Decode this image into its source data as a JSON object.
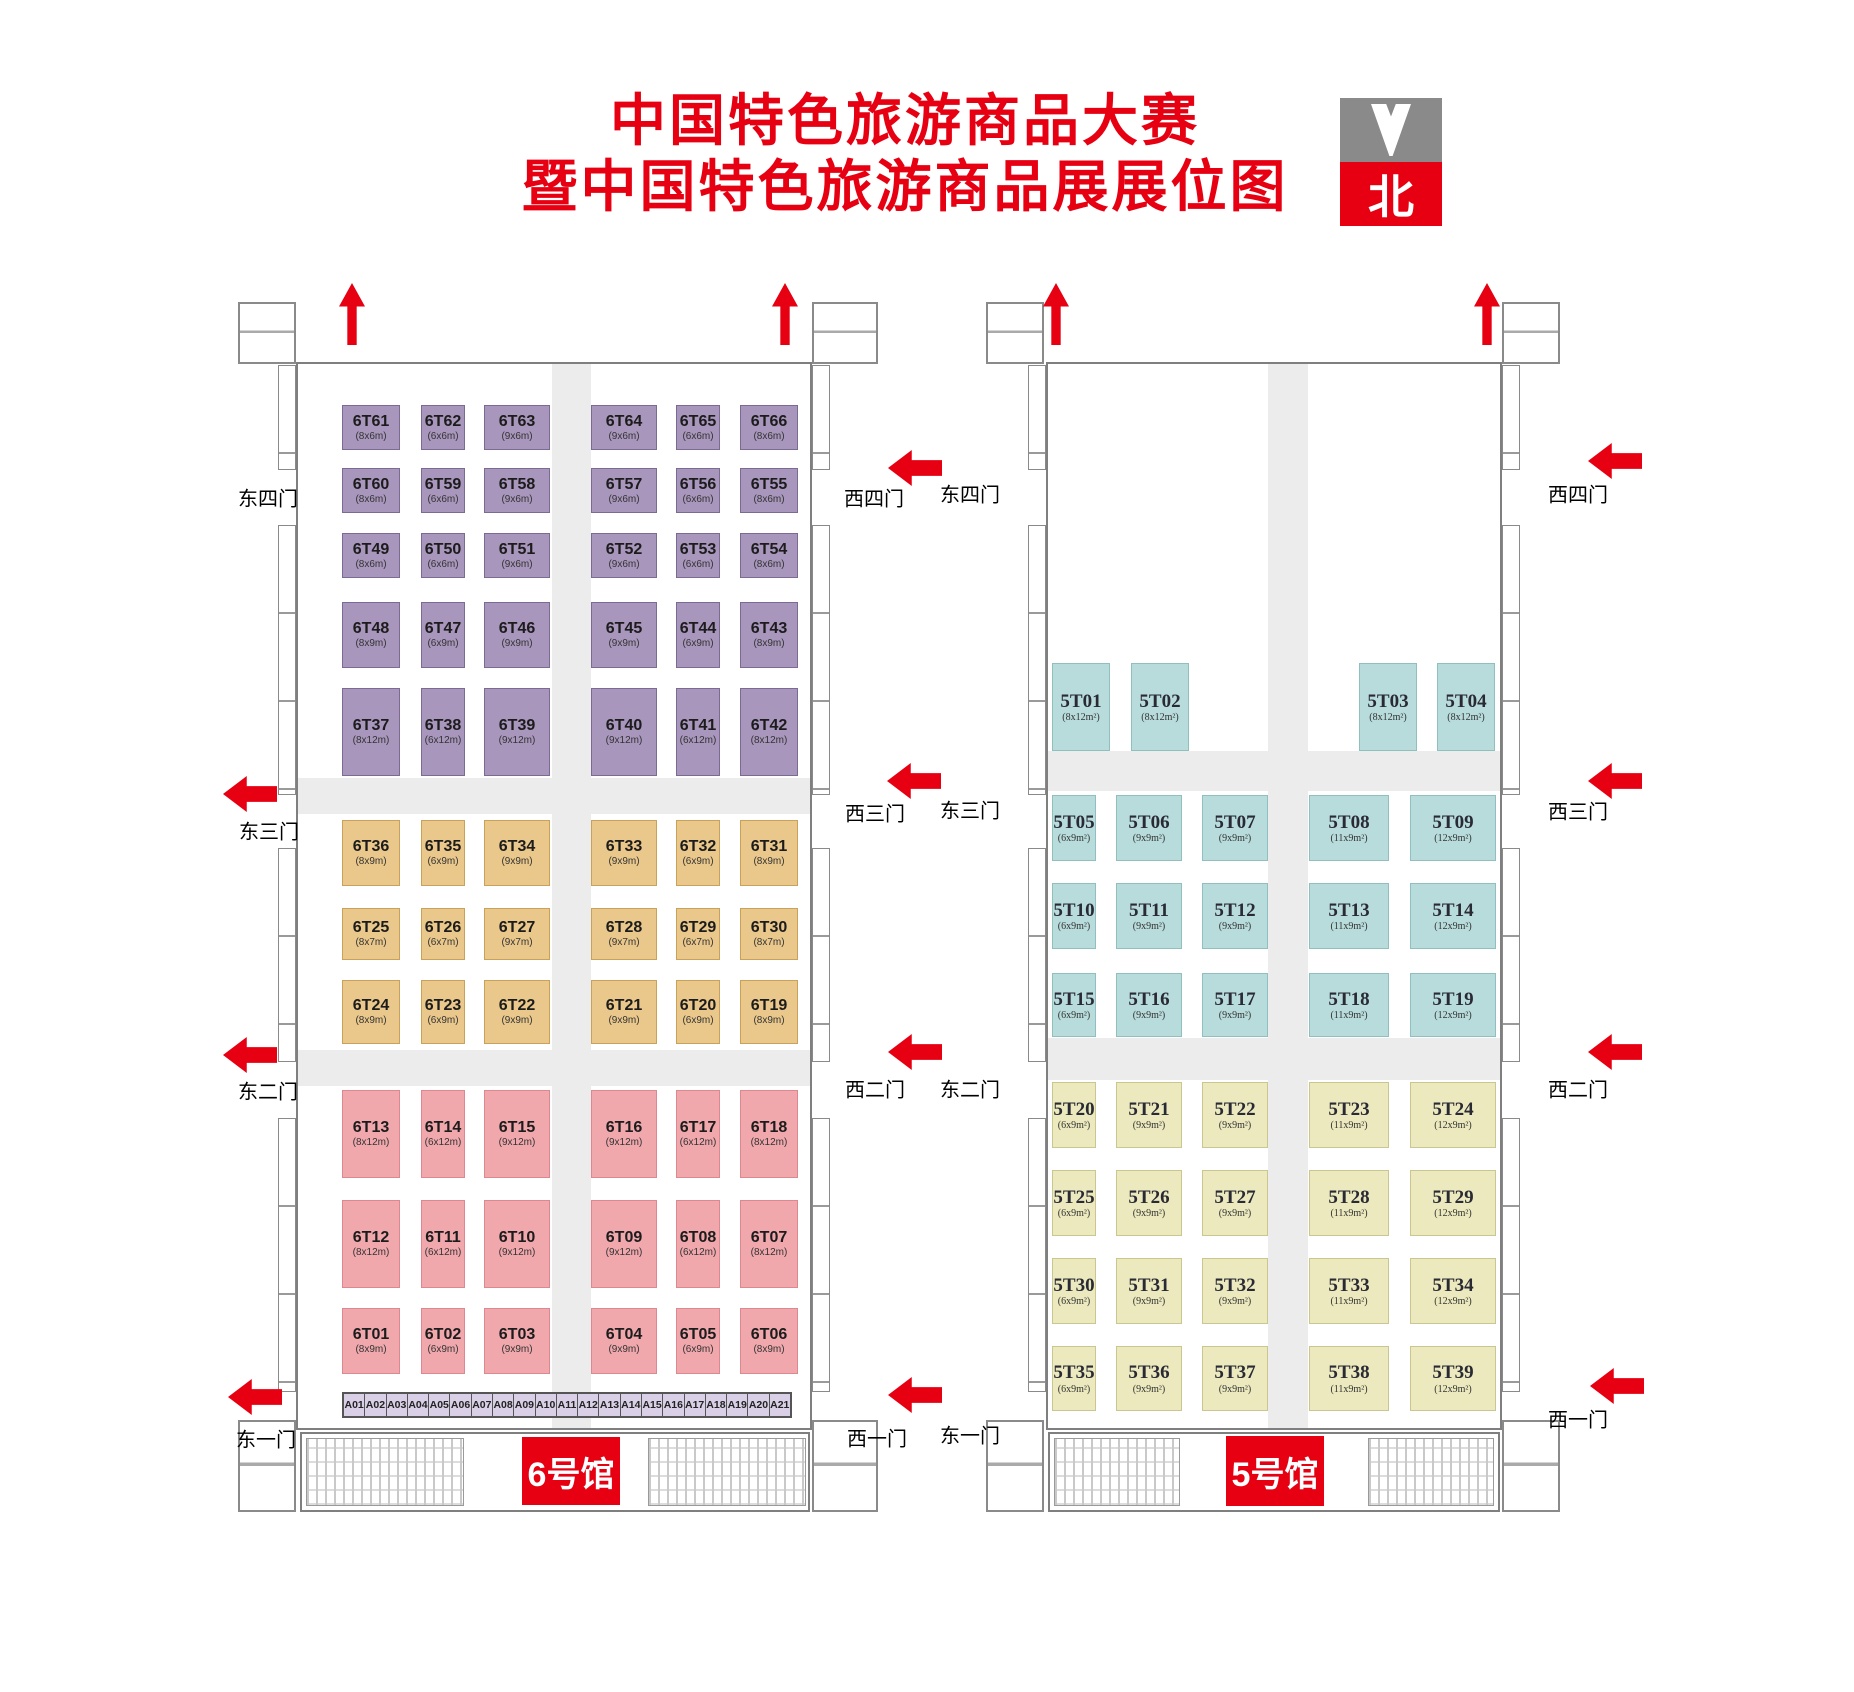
{
  "title": {
    "line1": "中国特色旅游商品大赛",
    "line2": "暨中国特色旅游商品展展位图"
  },
  "compass": {
    "label": "北"
  },
  "colors": {
    "red": "#e60012",
    "purple_booth": "#a896bc",
    "tan_booth": "#eac88b",
    "pink_booth": "#f1a8ad",
    "strip_booth": "#d9cfe6",
    "cyan_booth": "#b7dcdb",
    "yellow_booth": "#ebe9bd",
    "zone_pink": "#f7b3be",
    "aisle_gray": "#ececec",
    "aisle_text_orange": "#d9864f"
  },
  "hall6": {
    "badge": "6号馆",
    "main_aisle_label": "主通道",
    "gates_east": [
      "东四门",
      "东三门",
      "东二门",
      "东一门"
    ],
    "gates_west": [
      "西四门",
      "西三门",
      "西二门",
      "西一门"
    ],
    "booth_rows": [
      {
        "section": "purple",
        "booths": [
          [
            "6T61",
            "(8x6m)"
          ],
          [
            "6T62",
            "(6x6m)"
          ],
          [
            "6T63",
            "(9x6m)"
          ],
          [
            "6T64",
            "(9x6m)"
          ],
          [
            "6T65",
            "(6x6m)"
          ],
          [
            "6T66",
            "(8x6m)"
          ]
        ]
      },
      {
        "section": "purple",
        "booths": [
          [
            "6T60",
            "(8x6m)"
          ],
          [
            "6T59",
            "(6x6m)"
          ],
          [
            "6T58",
            "(9x6m)"
          ],
          [
            "6T57",
            "(9x6m)"
          ],
          [
            "6T56",
            "(6x6m)"
          ],
          [
            "6T55",
            "(8x6m)"
          ]
        ]
      },
      {
        "section": "purple",
        "booths": [
          [
            "6T49",
            "(8x6m)"
          ],
          [
            "6T50",
            "(6x6m)"
          ],
          [
            "6T51",
            "(9x6m)"
          ],
          [
            "6T52",
            "(9x6m)"
          ],
          [
            "6T53",
            "(6x6m)"
          ],
          [
            "6T54",
            "(8x6m)"
          ]
        ]
      },
      {
        "section": "purple",
        "booths": [
          [
            "6T48",
            "(8x9m)"
          ],
          [
            "6T47",
            "(6x9m)"
          ],
          [
            "6T46",
            "(9x9m)"
          ],
          [
            "6T45",
            "(9x9m)"
          ],
          [
            "6T44",
            "(6x9m)"
          ],
          [
            "6T43",
            "(8x9m)"
          ]
        ]
      },
      {
        "section": "purple",
        "booths": [
          [
            "6T37",
            "(8x12m)"
          ],
          [
            "6T38",
            "(6x12m)"
          ],
          [
            "6T39",
            "(9x12m)"
          ],
          [
            "6T40",
            "(9x12m)"
          ],
          [
            "6T41",
            "(6x12m)"
          ],
          [
            "6T42",
            "(8x12m)"
          ]
        ]
      },
      {
        "section": "tan",
        "booths": [
          [
            "6T36",
            "(8x9m)"
          ],
          [
            "6T35",
            "(6x9m)"
          ],
          [
            "6T34",
            "(9x9m)"
          ],
          [
            "6T33",
            "(9x9m)"
          ],
          [
            "6T32",
            "(6x9m)"
          ],
          [
            "6T31",
            "(8x9m)"
          ]
        ]
      },
      {
        "section": "tan",
        "booths": [
          [
            "6T25",
            "(8x7m)"
          ],
          [
            "6T26",
            "(6x7m)"
          ],
          [
            "6T27",
            "(9x7m)"
          ],
          [
            "6T28",
            "(9x7m)"
          ],
          [
            "6T29",
            "(6x7m)"
          ],
          [
            "6T30",
            "(8x7m)"
          ]
        ]
      },
      {
        "section": "tan",
        "booths": [
          [
            "6T24",
            "(8x9m)"
          ],
          [
            "6T23",
            "(6x9m)"
          ],
          [
            "6T22",
            "(9x9m)"
          ],
          [
            "6T21",
            "(9x9m)"
          ],
          [
            "6T20",
            "(6x9m)"
          ],
          [
            "6T19",
            "(8x9m)"
          ]
        ]
      },
      {
        "section": "pink",
        "booths": [
          [
            "6T13",
            "(8x12m)"
          ],
          [
            "6T14",
            "(6x12m)"
          ],
          [
            "6T15",
            "(9x12m)"
          ],
          [
            "6T16",
            "(9x12m)"
          ],
          [
            "6T17",
            "(6x12m)"
          ],
          [
            "6T18",
            "(8x12m)"
          ]
        ]
      },
      {
        "section": "pink",
        "booths": [
          [
            "6T12",
            "(8x12m)"
          ],
          [
            "6T11",
            "(6x12m)"
          ],
          [
            "6T10",
            "(9x12m)"
          ],
          [
            "6T09",
            "(9x12m)"
          ],
          [
            "6T08",
            "(6x12m)"
          ],
          [
            "6T07",
            "(8x12m)"
          ]
        ]
      },
      {
        "section": "pink",
        "booths": [
          [
            "6T01",
            "(8x9m)"
          ],
          [
            "6T02",
            "(6x9m)"
          ],
          [
            "6T03",
            "(9x9m)"
          ],
          [
            "6T04",
            "(9x9m)"
          ],
          [
            "6T05",
            "(6x9m)"
          ],
          [
            "6T06",
            "(8x9m)"
          ]
        ]
      }
    ],
    "strip_booths": [
      "A01",
      "A02",
      "A03",
      "A04",
      "A05",
      "A06",
      "A07",
      "A08",
      "A09",
      "A10",
      "A11",
      "A12",
      "A13",
      "A14",
      "A15",
      "A16",
      "A17",
      "A18",
      "A19",
      "A20",
      "A21"
    ]
  },
  "hall5": {
    "badge": "5号馆",
    "gates_east": [
      "东四门",
      "东三门",
      "东二门",
      "东一门"
    ],
    "gates_west": [
      "西四门",
      "西三门",
      "西二门",
      "西一门"
    ],
    "zone": {
      "title": "中国特色旅游商品大赛区",
      "size": "(62x32m²)",
      "entrance_label": "赛区入口"
    },
    "featured_booth": {
      "line1": "安徽省",
      "line2": "特色旅游商品区",
      "size": "(18x12m²)"
    },
    "top_row": [
      [
        "5T01",
        "(8x12m²)"
      ],
      [
        "5T02",
        "(8x12m²)"
      ],
      [
        "5T03",
        "(8x12m²)"
      ],
      [
        "5T04",
        "(8x12m²)"
      ]
    ],
    "booth_rows": [
      {
        "section": "cyan",
        "booths": [
          [
            "5T05",
            "(6x9m²)"
          ],
          [
            "5T06",
            "(9x9m²)"
          ],
          [
            "5T07",
            "(9x9m²)"
          ],
          [
            "5T08",
            "(11x9m²)"
          ],
          [
            "5T09",
            "(12x9m²)"
          ]
        ]
      },
      {
        "section": "cyan",
        "booths": [
          [
            "5T10",
            "(6x9m²)"
          ],
          [
            "5T11",
            "(9x9m²)"
          ],
          [
            "5T12",
            "(9x9m²)"
          ],
          [
            "5T13",
            "(11x9m²)"
          ],
          [
            "5T14",
            "(12x9m²)"
          ]
        ]
      },
      {
        "section": "cyan",
        "booths": [
          [
            "5T15",
            "(6x9m²)"
          ],
          [
            "5T16",
            "(9x9m²)"
          ],
          [
            "5T17",
            "(9x9m²)"
          ],
          [
            "5T18",
            "(11x9m²)"
          ],
          [
            "5T19",
            "(12x9m²)"
          ]
        ]
      },
      {
        "section": "yellow",
        "booths": [
          [
            "5T20",
            "(6x9m²)"
          ],
          [
            "5T21",
            "(9x9m²)"
          ],
          [
            "5T22",
            "(9x9m²)"
          ],
          [
            "5T23",
            "(11x9m²)"
          ],
          [
            "5T24",
            "(12x9m²)"
          ]
        ]
      },
      {
        "section": "yellow",
        "booths": [
          [
            "5T25",
            "(6x9m²)"
          ],
          [
            "5T26",
            "(9x9m²)"
          ],
          [
            "5T27",
            "(9x9m²)"
          ],
          [
            "5T28",
            "(11x9m²)"
          ],
          [
            "5T29",
            "(12x9m²)"
          ]
        ]
      },
      {
        "section": "yellow",
        "booths": [
          [
            "5T30",
            "(6x9m²)"
          ],
          [
            "5T31",
            "(9x9m²)"
          ],
          [
            "5T32",
            "(9x9m²)"
          ],
          [
            "5T33",
            "(11x9m²)"
          ],
          [
            "5T34",
            "(12x9m²)"
          ]
        ]
      },
      {
        "section": "yellow",
        "booths": [
          [
            "5T35",
            "(6x9m²)"
          ],
          [
            "5T36",
            "(9x9m²)"
          ],
          [
            "5T37",
            "(9x9m²)"
          ],
          [
            "5T38",
            "(11x9m²)"
          ],
          [
            "5T39",
            "(12x9m²)"
          ]
        ]
      }
    ]
  }
}
